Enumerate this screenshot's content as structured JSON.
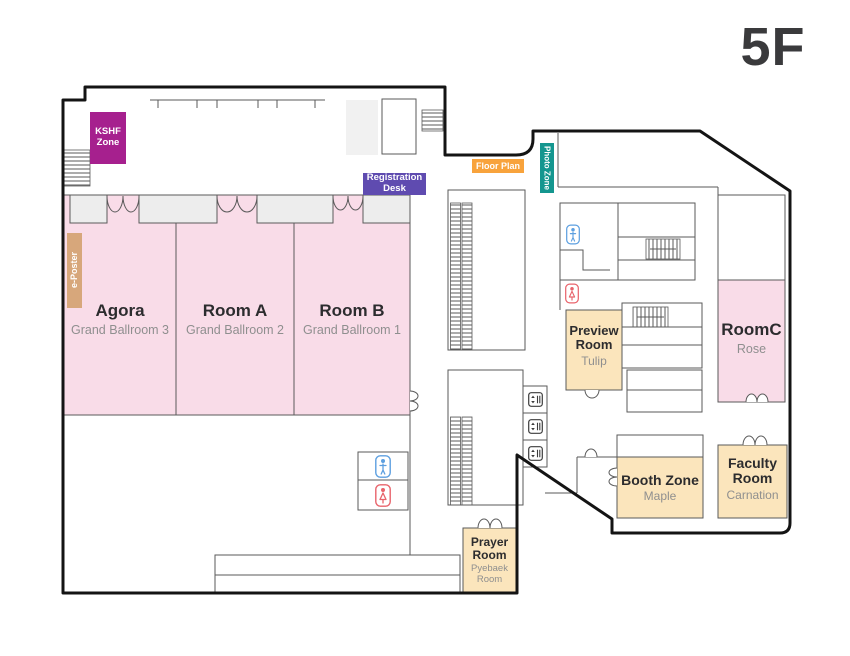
{
  "floor_label": "5F",
  "zones": {
    "kshf": {
      "label": "KSHF Zone",
      "color": "#a6208e"
    },
    "registration": {
      "label": "Registration Desk",
      "color": "#5f4bb0"
    },
    "floorplan": {
      "label": "Floor Plan",
      "color": "#f8a33c"
    },
    "photozone": {
      "label": "Photo Zone",
      "color": "#14968f"
    },
    "eposter": {
      "label": "e-Poster",
      "color": "#d7a77b"
    }
  },
  "rooms": {
    "agora": {
      "name": "Agora",
      "subtitle": "Grand Ballroom 3",
      "color": "#f9dce8"
    },
    "room_a": {
      "name": "Room A",
      "subtitle": "Grand Ballroom 2",
      "color": "#f9dce8"
    },
    "room_b": {
      "name": "Room B",
      "subtitle": "Grand Ballroom 1",
      "color": "#f9dce8"
    },
    "room_c": {
      "name": "RoomC",
      "subtitle": "Rose",
      "color": "#f9dce8"
    },
    "preview": {
      "name": "Preview Room",
      "subtitle": "Tulip",
      "color": "#fbe5bc"
    },
    "booth": {
      "name": "Booth Zone",
      "subtitle": "Maple",
      "color": "#fbe5bc"
    },
    "faculty": {
      "name": "Faculty Room",
      "subtitle": "Carnation",
      "color": "#fbe5bc"
    },
    "prayer": {
      "name": "Prayer Room",
      "subtitle": "Pyebaek Room",
      "color": "#fbe5bc"
    }
  },
  "icons": {
    "male_restroom": {
      "name": "male-restroom-icon",
      "color": "#5c9fe0"
    },
    "female_restroom": {
      "name": "female-restroom-icon",
      "color": "#e8636b"
    },
    "elevator": {
      "name": "elevator-icon",
      "color": "#3c3c3c"
    },
    "escalator": {
      "name": "escalator-hatch",
      "color": "#5a5a5a"
    },
    "stairs": {
      "name": "stairs-hatch",
      "color": "#5a5a5a"
    }
  },
  "colors": {
    "outer_wall": "#141414",
    "inner_wall": "#5a5a5a",
    "header_box": "#ededed",
    "title_text": "#3a3a3c",
    "subtitle_text": "#8f8f8f"
  }
}
